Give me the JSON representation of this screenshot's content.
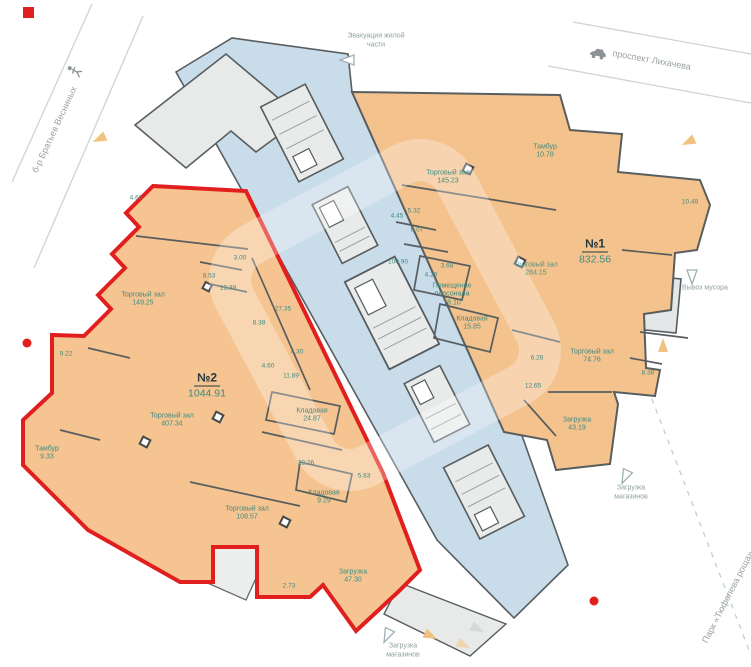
{
  "colors": {
    "unit_fill": "#f4c28c",
    "corridor_fill": "#c9dce9",
    "gray_room_fill": "#e8eaea",
    "wall": "#585d5f",
    "red_outline": "#e11f1f",
    "teal_text": "#3f8b82",
    "gray_text": "#9aa1a2"
  },
  "streets": {
    "prospekt": "проспект Лихачева",
    "bulvar": "б-р Братьев Весниных",
    "park": "Парк «Тюфелева роща»"
  },
  "annotations": {
    "evacuation": "Эвакуация жилой части",
    "trash": "Вывоз мусора",
    "loading_bottom": "Загрузка магазинов",
    "loading_right": "Загрузка магазинов"
  },
  "units": {
    "unit1": {
      "number": "№1",
      "area": "832.56",
      "rooms": [
        {
          "name": "Торговый зал",
          "area": "145.23"
        },
        {
          "name": "Тамбур",
          "area": "10.78"
        },
        {
          "name": "Торговый зал",
          "area": "284.15"
        },
        {
          "name": "Помещение персонала",
          "area": "18.10"
        },
        {
          "name": "Кладовая",
          "area": "15.85"
        },
        {
          "name": "Торговый зал",
          "area": "74.76"
        },
        {
          "name": "Загрузка",
          "area": "43.19"
        }
      ],
      "dims": [
        "4.45",
        "5.32",
        "6.07",
        "100.90",
        "3.68",
        "4.29",
        "6.26",
        "12.65",
        "8.38",
        "10.49"
      ]
    },
    "unit2": {
      "number": "№2",
      "area": "1044.91",
      "rooms": [
        {
          "name": "Торговый зал",
          "area": "149.25"
        },
        {
          "name": "Торговый зал",
          "area": "407.34"
        },
        {
          "name": "Торговый зал",
          "area": "108.57"
        },
        {
          "name": "Кладовая",
          "area": "24.87"
        },
        {
          "name": "Кладовая",
          "area": "9.29"
        },
        {
          "name": "Загрузка",
          "area": "47.30"
        },
        {
          "name": "Тамбур",
          "area": "9.33"
        }
      ],
      "dims": [
        "4.66",
        "8.53",
        "12.39",
        "3.00",
        "27.35",
        "8.38",
        "4.30",
        "4.60",
        "11.89",
        "9.22",
        "22.26",
        "5.83",
        "2.73"
      ]
    }
  }
}
